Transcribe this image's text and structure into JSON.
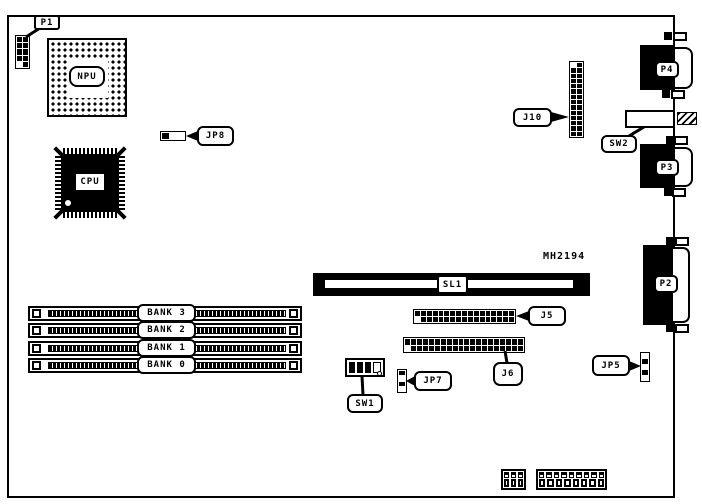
{
  "board": {
    "part_number": "MH2194"
  },
  "labels": {
    "p1": "P1",
    "npu": "NPU",
    "cpu": "CPU",
    "jp8": "JP8",
    "j10": "J10",
    "sw2": "SW2",
    "p4": "P4",
    "p3": "P3",
    "p2": "P2",
    "sl1": "SL1",
    "j5": "J5",
    "j6": "J6",
    "sw1": "SW1",
    "jp7": "JP7",
    "jp5": "JP5",
    "bank3": "BANK 3",
    "bank2": "BANK 2",
    "bank1": "BANK 1",
    "bank0": "BANK 0"
  }
}
